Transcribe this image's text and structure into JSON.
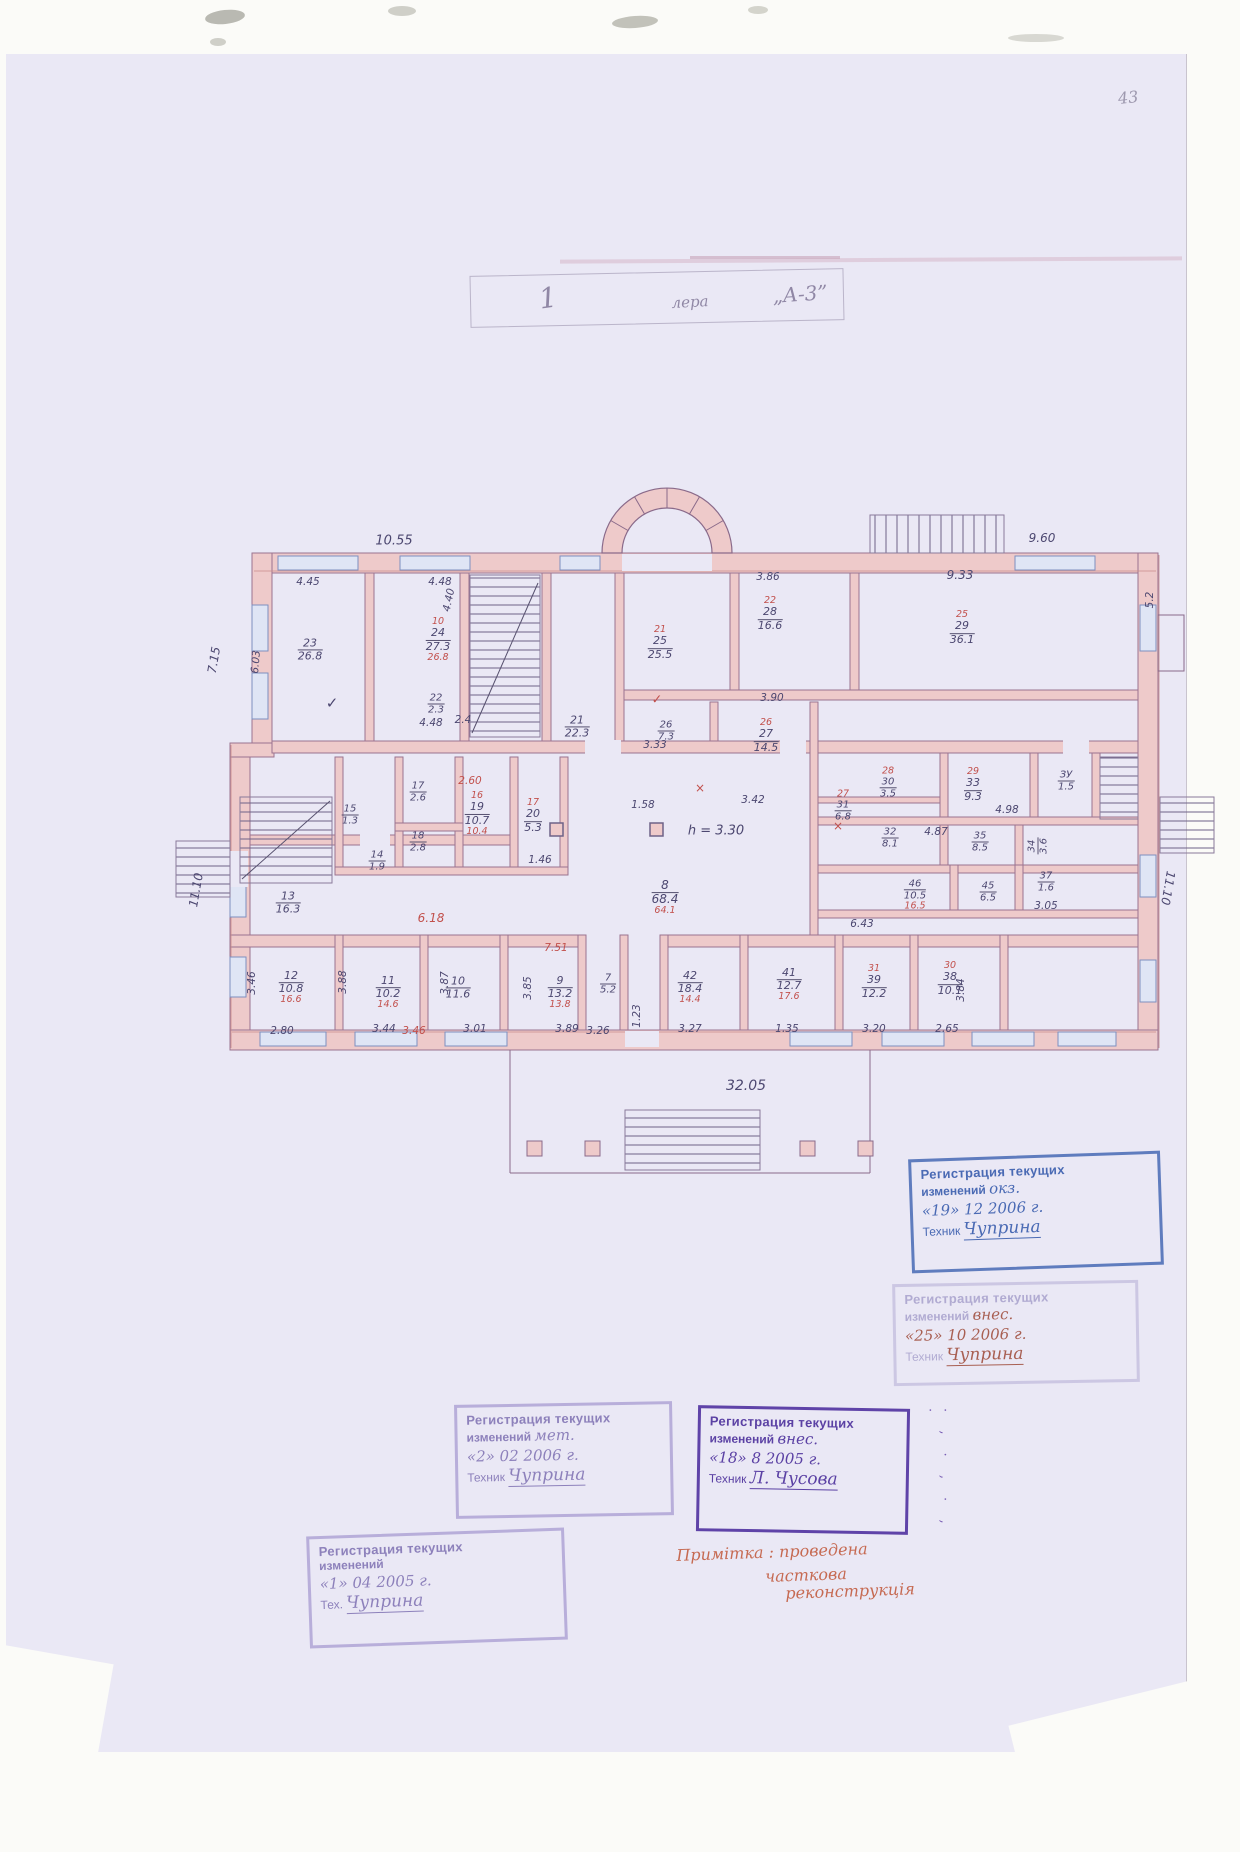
{
  "page": {
    "number": "43"
  },
  "title": {
    "fragments": [
      {
        "t": "1",
        "x": 548,
        "y": 298,
        "fs": 28,
        "rot": -8
      },
      {
        "t": "лера",
        "x": 690,
        "y": 302,
        "fs": 15,
        "rot": -3
      },
      {
        "t": "„А-3”",
        "x": 800,
        "y": 294,
        "fs": 20,
        "rot": -4
      }
    ]
  },
  "plan": {
    "rooms": [
      {
        "num": "23",
        "area": "26.8",
        "x": 310,
        "y": 650
      },
      {
        "num": "24",
        "area": "27.3",
        "red_num": "10",
        "red_area": "26.8",
        "x": 438,
        "y": 640
      },
      {
        "num": "22",
        "area": "2.3",
        "x": 436,
        "y": 704,
        "fs": 10
      },
      {
        "num": "21",
        "area": "22.3",
        "x": 577,
        "y": 727
      },
      {
        "num": "25",
        "area": "25.5",
        "red_num": "21",
        "x": 660,
        "y": 643
      },
      {
        "num": "28",
        "area": "16.6",
        "red_num": "22",
        "x": 770,
        "y": 614
      },
      {
        "num": "29",
        "area": "36.1",
        "red_num": "25",
        "x": 962,
        "y": 628
      },
      {
        "num": "26",
        "area": "7.3",
        "x": 666,
        "y": 731,
        "fs": 10
      },
      {
        "num": "27",
        "area": "14.5",
        "red_num": "26",
        "x": 766,
        "y": 736
      },
      {
        "num": "13",
        "area": "16.3",
        "x": 288,
        "y": 903
      },
      {
        "num": "15",
        "area": "1.3",
        "x": 350,
        "y": 815,
        "fs": 10
      },
      {
        "num": "17",
        "area": "2.6",
        "x": 418,
        "y": 792,
        "fs": 10
      },
      {
        "num": "18",
        "area": "2.8",
        "x": 418,
        "y": 842,
        "fs": 10
      },
      {
        "num": "14",
        "area": "1.9",
        "x": 377,
        "y": 861,
        "fs": 10
      },
      {
        "num": "19",
        "area": "10.7",
        "red_num": "16",
        "red_area": "10.4",
        "x": 477,
        "y": 814
      },
      {
        "num": "20",
        "area": "5.3",
        "red_num": "17",
        "x": 533,
        "y": 816
      },
      {
        "num": "8",
        "area": "68.4",
        "red_area": "64.1",
        "x": 665,
        "y": 898,
        "fs": 12
      },
      {
        "num": "30",
        "area": "3.5",
        "red_num": "28",
        "x": 888,
        "y": 783,
        "fs": 10
      },
      {
        "num": "31",
        "area": "6.8",
        "red_num": "27",
        "x": 843,
        "y": 806,
        "fs": 10
      },
      {
        "num": "33",
        "area": "9.3",
        "red_num": "29",
        "x": 973,
        "y": 785
      },
      {
        "num": "ЗУ",
        "area": "1.5",
        "x": 1066,
        "y": 781,
        "fs": 10
      },
      {
        "num": "32",
        "area": "8.1",
        "x": 890,
        "y": 838,
        "fs": 10
      },
      {
        "num": "35",
        "area": "8.5",
        "x": 980,
        "y": 842,
        "fs": 10
      },
      {
        "num": "34",
        "area": "3.6",
        "x": 1038,
        "y": 846,
        "rot": -90,
        "fs": 10
      },
      {
        "num": "46",
        "area": "10.5",
        "red_area": "16.5",
        "x": 915,
        "y": 895,
        "fs": 10
      },
      {
        "num": "45",
        "area": "6.5",
        "x": 988,
        "y": 892,
        "fs": 10
      },
      {
        "num": "37",
        "area": "1.6",
        "x": 1046,
        "y": 882,
        "fs": 10
      },
      {
        "num": "12",
        "area": "10.8",
        "red_area": "16.6",
        "x": 291,
        "y": 988
      },
      {
        "num": "11",
        "area": "10.2",
        "red_area": "14.6",
        "x": 388,
        "y": 993
      },
      {
        "num": "10",
        "area": "11.6",
        "x": 458,
        "y": 988
      },
      {
        "num": "9",
        "area": "13.2",
        "red_area": "13.8",
        "x": 560,
        "y": 993
      },
      {
        "num": "7",
        "area": "5.2",
        "x": 608,
        "y": 984,
        "fs": 10
      },
      {
        "num": "42",
        "area": "18.4",
        "red_area": "14.4",
        "x": 690,
        "y": 988
      },
      {
        "num": "41",
        "area": "12.7",
        "red_area": "17.6",
        "x": 789,
        "y": 985
      },
      {
        "num": "39",
        "area": "12.2",
        "red_num": "31",
        "x": 874,
        "y": 982
      },
      {
        "num": "38",
        "area": "10.1",
        "red_num": "30",
        "x": 950,
        "y": 979
      }
    ],
    "dims": [
      {
        "t": "10.55",
        "x": 394,
        "y": 541,
        "fs": 13
      },
      {
        "t": "9.60",
        "x": 1042,
        "y": 538,
        "fs": 12
      },
      {
        "t": "4.45",
        "x": 308,
        "y": 582
      },
      {
        "t": "4.48",
        "x": 440,
        "y": 582
      },
      {
        "t": "3.86",
        "x": 768,
        "y": 577
      },
      {
        "t": "9.33",
        "x": 960,
        "y": 575,
        "fs": 12
      },
      {
        "t": "7.15",
        "x": 214,
        "y": 660,
        "rot": -80,
        "fs": 12
      },
      {
        "t": "6.03",
        "x": 256,
        "y": 662,
        "rot": -85
      },
      {
        "t": "4.40",
        "x": 449,
        "y": 600,
        "rot": -78
      },
      {
        "t": "11.10",
        "x": 196,
        "y": 890,
        "rot": -80,
        "fs": 12
      },
      {
        "t": "11.10",
        "x": 1168,
        "y": 888,
        "rot": 100,
        "fs": 12
      },
      {
        "t": "5.2",
        "x": 1150,
        "y": 600,
        "rot": -90
      },
      {
        "t": "4.48",
        "x": 431,
        "y": 723
      },
      {
        "t": "2.4",
        "x": 463,
        "y": 720
      },
      {
        "t": "3.33",
        "x": 655,
        "y": 745
      },
      {
        "t": "3.90",
        "x": 772,
        "y": 698
      },
      {
        "t": "1.58",
        "x": 643,
        "y": 805
      },
      {
        "t": "3.42",
        "x": 753,
        "y": 800
      },
      {
        "t": "h = 3.30",
        "x": 716,
        "y": 831,
        "fs": 13
      },
      {
        "t": "2.60",
        "x": 470,
        "y": 781,
        "cls": "red"
      },
      {
        "t": "1.46",
        "x": 540,
        "y": 860
      },
      {
        "t": "6.18",
        "x": 431,
        "y": 918,
        "cls": "red",
        "fs": 12
      },
      {
        "t": "6.43",
        "x": 862,
        "y": 924
      },
      {
        "t": "4.87",
        "x": 936,
        "y": 832
      },
      {
        "t": "4.98",
        "x": 1007,
        "y": 810
      },
      {
        "t": "2.80",
        "x": 282,
        "y": 1031
      },
      {
        "t": "3.44",
        "x": 384,
        "y": 1029
      },
      {
        "t": "3.46",
        "x": 414,
        "y": 1031,
        "cls": "red"
      },
      {
        "t": "3.01",
        "x": 475,
        "y": 1029
      },
      {
        "t": "3.89",
        "x": 567,
        "y": 1029
      },
      {
        "t": "3.26",
        "x": 598,
        "y": 1031
      },
      {
        "t": "3.27",
        "x": 690,
        "y": 1029
      },
      {
        "t": "1.35",
        "x": 787,
        "y": 1029
      },
      {
        "t": "3.20",
        "x": 874,
        "y": 1029
      },
      {
        "t": "2.65",
        "x": 947,
        "y": 1029
      },
      {
        "t": "3.05",
        "x": 1046,
        "y": 906
      },
      {
        "t": "32.05",
        "x": 746,
        "y": 1086,
        "fs": 14
      },
      {
        "t": "3.46",
        "x": 252,
        "y": 983,
        "rot": -90
      },
      {
        "t": "3.88",
        "x": 343,
        "y": 982,
        "rot": -90
      },
      {
        "t": "3.87",
        "x": 445,
        "y": 983,
        "rot": -90
      },
      {
        "t": "3.85",
        "x": 528,
        "y": 988,
        "rot": -90
      },
      {
        "t": "3.84",
        "x": 961,
        "y": 990,
        "rot": -90
      },
      {
        "t": "1.23",
        "x": 637,
        "y": 1016,
        "rot": -90
      },
      {
        "t": "7.51",
        "x": 556,
        "y": 948,
        "cls": "red"
      },
      {
        "t": "✓",
        "x": 332,
        "y": 703,
        "fs": 15
      },
      {
        "t": "✓",
        "x": 657,
        "y": 700,
        "cls": "red",
        "fs": 13
      },
      {
        "t": "×",
        "x": 838,
        "y": 826,
        "cls": "red",
        "fs": 12
      },
      {
        "t": "×",
        "x": 700,
        "y": 788,
        "cls": "red",
        "fs": 12
      }
    ]
  },
  "stamps": [
    {
      "cls": "st-blue",
      "x": 910,
      "y": 1155,
      "w": 252,
      "h": 114,
      "rot": -2,
      "l1": "Регистрация текущих",
      "l2": "изменений",
      "hw": "окз.",
      "date": "«19»  12  2006 г.",
      "role": "Техник",
      "sig": "Чуприна"
    },
    {
      "cls": "st-ghost",
      "x": 893,
      "y": 1282,
      "w": 246,
      "h": 102,
      "rot": -1,
      "l1": "Регистрация текущих",
      "l2": "изменений",
      "hw": "внес.",
      "date": "«25»  10  2006 г.",
      "role": "Техник",
      "sig": "Чуприна"
    },
    {
      "cls": "st-violet",
      "x": 455,
      "y": 1403,
      "w": 218,
      "h": 114,
      "rot": -1,
      "l1": "Регистрация текущих",
      "l2": "изменений",
      "hw": "мет.",
      "date": "«2»  02  2006 г.",
      "role": "Техник",
      "sig": "Чуприна"
    },
    {
      "cls": "st-purple",
      "x": 697,
      "y": 1407,
      "w": 212,
      "h": 126,
      "rot": 1,
      "l1": "Регистрация текущих",
      "l2": "изменений",
      "hw": "внес.",
      "date": "«18»  8  2005 г.",
      "role": "Техник",
      "sig": "Л. Чусова"
    },
    {
      "cls": "st-violet",
      "x": 308,
      "y": 1532,
      "w": 258,
      "h": 112,
      "rot": -2,
      "l1": "Регистрация текущих",
      "l2": "изменений",
      "hw": "",
      "date": "«1»  04  2005 г.",
      "role": "Тех.",
      "sig": "Чуприна"
    }
  ],
  "margin_marks": {
    "text": "· ‚ · ‚ · ‚ ·"
  },
  "note": {
    "lines": [
      {
        "t": "Примітка : проведена",
        "x": 772,
        "y": 1552,
        "rot": -2
      },
      {
        "t": "часткова",
        "x": 806,
        "y": 1575,
        "rot": -2
      },
      {
        "t": "реконструкція",
        "x": 850,
        "y": 1591,
        "rot": -2
      }
    ]
  }
}
